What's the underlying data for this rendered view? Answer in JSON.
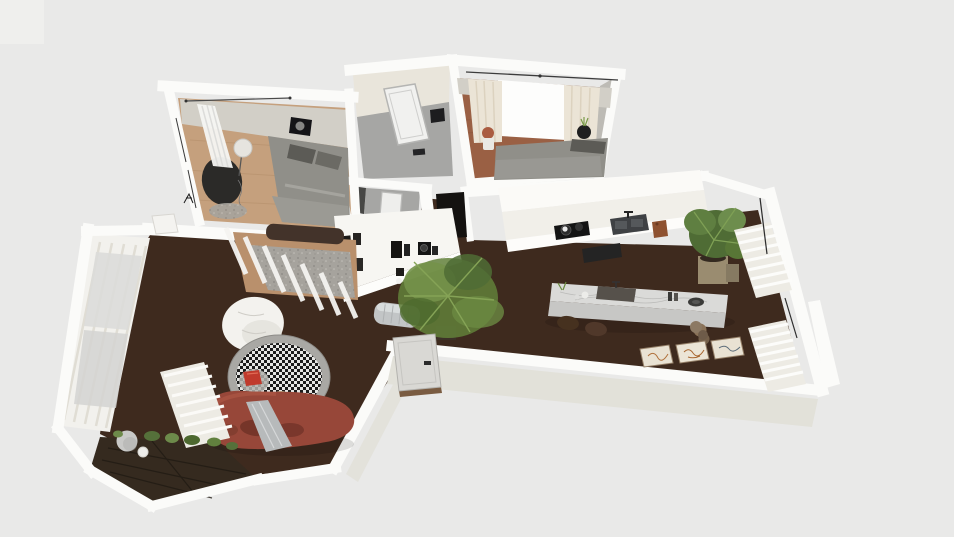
{
  "scene": {
    "type": "3d-floorplan-render",
    "description": "Top-down isometric 3D rendering of an apartment floor plan with furniture, no visible text",
    "rooms": [
      {
        "name": "bedroom-top-left",
        "floor": "light oak wood",
        "furniture": [
          "double bed with gray bedding and dark pillows",
          "round dark ottoman",
          "white globe floor lamp",
          "sheer white window curtain",
          "black wall art with moon",
          "small speckled rug",
          "sketch coat rack"
        ]
      },
      {
        "name": "bathroom-upper",
        "floor": "gray tile",
        "furniture": [
          "white shower tray",
          "black wall radiator",
          "small black floor item"
        ]
      },
      {
        "name": "bathroom-lower",
        "floor": "gray tile",
        "furniture": [
          "white shower tray"
        ]
      },
      {
        "name": "bedroom-top-right",
        "floor": "red-brown wood",
        "furniture": [
          "double bed with gray bedding",
          "cream curtains on rod",
          "bright window",
          "terracotta planter",
          "black planter with sprig"
        ]
      },
      {
        "name": "hallway",
        "floor": "dark walnut",
        "furniture": [
          "open dark doorway",
          "white console shelf with black books and speakers",
          "silver radiator",
          "large potted plant"
        ]
      },
      {
        "name": "kitchen",
        "floor": "dark walnut",
        "furniture": [
          "white upper cabinets",
          "white counter with black cooktop and pots",
          "double sink with faucet",
          "wooden cutting board",
          "dark oven front",
          "marble island with sink, bottles and plate",
          "two dark wood bar stools",
          "stacked clay pots",
          "tall potted plant in tan planter",
          "white louver shutter panels",
          "three framed line-art prints on floor",
          "entrance door with black handle"
        ]
      },
      {
        "name": "living-room",
        "floor": "dark walnut",
        "furniture": [
          "round houndstooth rug with gray border",
          "red cushion",
          "serving tray with cups",
          "curved terracotta sofa with gray throw",
          "white bean bag",
          "glass partition with white mullions",
          "gray rug with dark console table",
          "white shutter radiator",
          "floor-to-ceiling curtain wall",
          "white door leaf"
        ]
      },
      {
        "name": "balcony",
        "floor": "dark wood decking",
        "furniture": [
          "edge planter greenery",
          "gray decorative sphere",
          "small white pot"
        ]
      }
    ]
  },
  "palette": {
    "bg": "#e9e9e8",
    "wall": "#fbfbf9",
    "wallFace": "#e2e1d9",
    "roomFace": "#d2cfc7",
    "wallGrayFace": "#bdbbb5",
    "woodLight": "#c5a07d",
    "woodRed": "#9a6044",
    "woodMid": "#b9906c",
    "floorDark": "#3e2a1e",
    "floorGray": "#a6a6a4",
    "deck": "#352a1f",
    "marbleTop": "#dadad8",
    "marbleFront": "#c7c7c5",
    "counter": "#f1efe9",
    "cabinet": "#fbfaf7",
    "sofa": "#974739",
    "sofaShadow": "#6e3126",
    "bedGray": "#908f89",
    "pillowDark": "#5c5b56",
    "curtain": "#ebe4d6",
    "curtainWhite": "#f5f5f3",
    "consoleWhite": "#f7f6f2",
    "metal": "#c2c5c6",
    "black": "#161514",
    "plant": "#62803a",
    "plantDark": "#4f6c35",
    "plantLight": "#74924a",
    "potTan": "#9a8c70",
    "terracotta": "#aa5c41",
    "rugGray": "#a6a39d",
    "beanbag": "#f3f2ee",
    "red": "#c03a2c",
    "doorGray": "#d9d8d4",
    "shutter": "#edebe4",
    "sphere": "#c9c9c7",
    "frame": "#e9e2d3"
  }
}
